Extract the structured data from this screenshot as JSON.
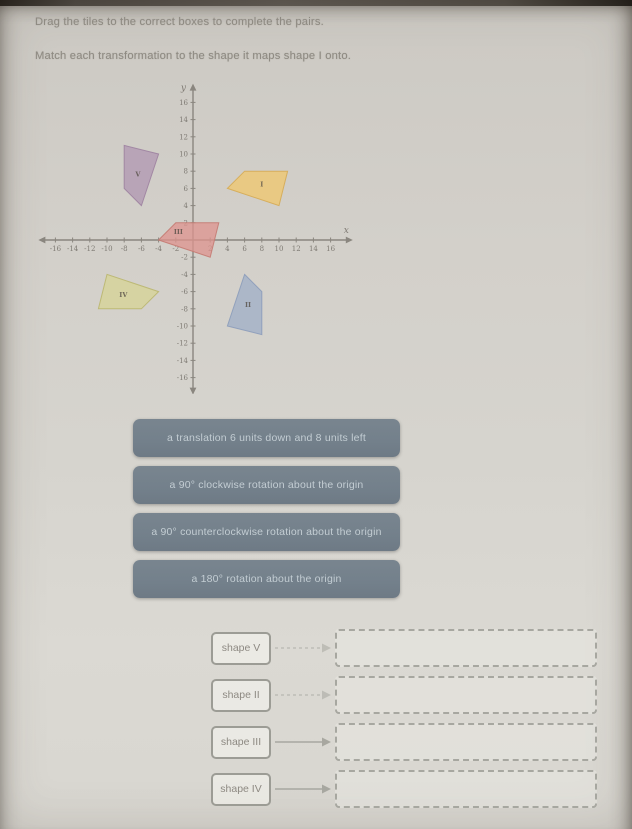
{
  "instructions": {
    "line1": "Drag the tiles to the correct boxes to complete the pairs.",
    "line2": "Match each transformation to the shape it maps shape I onto."
  },
  "graph": {
    "x_label": "x",
    "y_label": "y",
    "axis_range": [
      -16,
      16
    ],
    "tick_step": 2,
    "grid": false,
    "x_ticks": [
      -16,
      -14,
      -12,
      -10,
      -8,
      -6,
      -4,
      -2,
      2,
      4,
      6,
      8,
      10,
      12,
      14,
      16
    ],
    "y_ticks": [
      -16,
      -14,
      -12,
      -10,
      -8,
      -6,
      -4,
      -2,
      2,
      4,
      6,
      8,
      10,
      12,
      14,
      16
    ],
    "shapes": [
      {
        "label": "I",
        "points": [
          [
            4,
            6
          ],
          [
            6,
            8
          ],
          [
            11,
            8
          ],
          [
            10,
            4
          ]
        ],
        "fill": "#edc877",
        "stroke": "#d5ab55",
        "opacity": 0.85,
        "label_pos": [
          8,
          6.2
        ]
      },
      {
        "label": "V",
        "points": [
          [
            -6,
            4
          ],
          [
            -8,
            6
          ],
          [
            -8,
            11
          ],
          [
            -4,
            10
          ]
        ],
        "fill": "#b29ab3",
        "stroke": "#9d82a0",
        "opacity": 0.8,
        "label_pos": [
          -6.4,
          7.4
        ]
      },
      {
        "label": "III",
        "points": [
          [
            -4,
            0
          ],
          [
            -2,
            2
          ],
          [
            3,
            2
          ],
          [
            2,
            -2
          ]
        ],
        "fill": "#dd938d",
        "stroke": "#c47a72",
        "opacity": 0.75,
        "label_pos": [
          -1.7,
          0.7
        ]
      },
      {
        "label": "IV",
        "points": [
          [
            -4,
            -6
          ],
          [
            -6,
            -8
          ],
          [
            -11,
            -8
          ],
          [
            -10,
            -4
          ]
        ],
        "fill": "#d6d39b",
        "stroke": "#bab66f",
        "opacity": 0.85,
        "label_pos": [
          -8.1,
          -6.6
        ]
      },
      {
        "label": "II",
        "points": [
          [
            6,
            -4
          ],
          [
            8,
            -6
          ],
          [
            8,
            -11
          ],
          [
            4,
            -10
          ]
        ],
        "fill": "#a5b3c8",
        "stroke": "#8c9cba",
        "opacity": 0.85,
        "label_pos": [
          6.4,
          -7.8
        ]
      }
    ]
  },
  "tiles": [
    {
      "label": "a translation 6 units down and 8 units left"
    },
    {
      "label": "a 90° clockwise rotation about the origin"
    },
    {
      "label": "a 90° counterclockwise rotation about the origin"
    },
    {
      "label": "a 180° rotation about the origin"
    }
  ],
  "matches": [
    {
      "label": "shape V"
    },
    {
      "label": "shape II"
    },
    {
      "label": "shape III"
    },
    {
      "label": "shape IV"
    }
  ],
  "colors": {
    "tile_bg": "#73808b",
    "tile_text": "#c3cdd3",
    "axis": "#8a867f",
    "instruction_text": "#8e8a82",
    "box_border": "#9c9c95"
  }
}
